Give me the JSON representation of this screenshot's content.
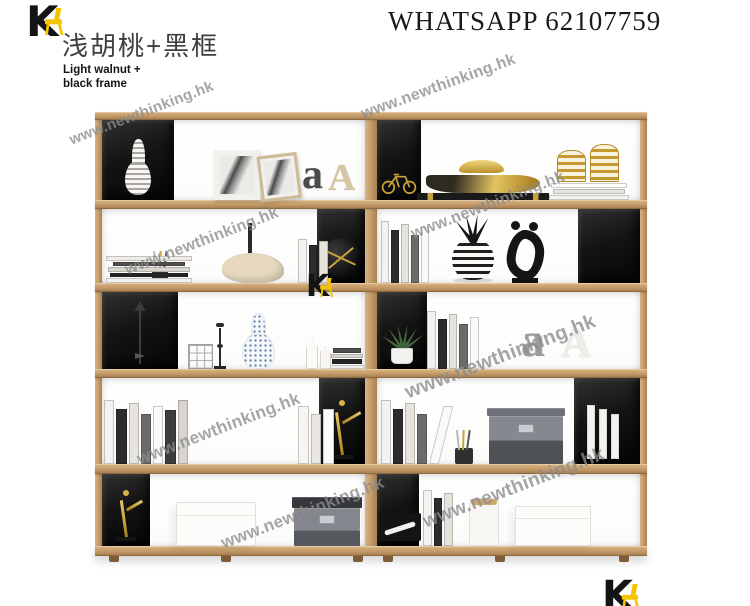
{
  "branding": {
    "logo_letter": "K",
    "logo_black": "#141414",
    "logo_yellow": "#f5c400",
    "title_cn": "浅胡桃+黑框",
    "title_en_line1": "Light walnut +",
    "title_en_line2": "black frame",
    "contact": "WHATSAPP 62107759"
  },
  "watermark": {
    "text": "www.newthinking.hk",
    "color": "#8c8c8c",
    "instances": [
      {
        "x": 70,
        "y": 132,
        "size": 15,
        "rot": -21
      },
      {
        "x": 362,
        "y": 106,
        "size": 16,
        "rot": -20
      },
      {
        "x": 126,
        "y": 262,
        "size": 16,
        "rot": -21
      },
      {
        "x": 412,
        "y": 226,
        "size": 16,
        "rot": -21
      },
      {
        "x": 138,
        "y": 450,
        "size": 17,
        "rot": -21
      },
      {
        "x": 406,
        "y": 382,
        "size": 20,
        "rot": -21
      },
      {
        "x": 424,
        "y": 512,
        "size": 19,
        "rot": -21
      },
      {
        "x": 222,
        "y": 534,
        "size": 17,
        "rot": -21
      }
    ]
  },
  "shelf": {
    "colors": {
      "wood_face": "#c79e6c",
      "wood_top": "#dcb988",
      "wood_edge": "#9a7243",
      "box": "#131313",
      "gold": "#c8a23c"
    },
    "units": [
      {
        "name": "left-unit",
        "rows": [
          {
            "box": "left",
            "box_item": {
              "kind": "vase",
              "name": "white-striped-vase",
              "w": 26,
              "h": 56
            },
            "items": [
              {
                "kind": "frame",
                "name": "white-picture-frame",
                "x": 112,
                "w": 46,
                "h": 50,
                "frame": "#f3f1ec"
              },
              {
                "kind": "frame",
                "name": "leaning-picture-frame",
                "x": 160,
                "w": 40,
                "h": 46,
                "frame": "#cdbb97",
                "lean": -7
              },
              {
                "kind": "letters",
                "name": "letter-a-ornament",
                "x": 200,
                "h": 42,
                "text": "a",
                "color": "#4c4c4c"
              },
              {
                "kind": "letters",
                "name": "letter-A-ornament",
                "x": 226,
                "h": 38,
                "text": "A",
                "color": "#d8c5a2"
              }
            ]
          },
          {
            "box": "right",
            "box_item": {
              "kind": "circle_fan",
              "name": "black-fan-clock",
              "w": 40,
              "h": 40
            },
            "items": [
              {
                "kind": "stick",
                "name": "spike-ornament",
                "x": 146,
                "w": 4,
                "h": 60,
                "color": "#2a2a2a"
              },
              {
                "kind": "pen_cup",
                "name": "pencil-cup",
                "x": 50,
                "w": 16,
                "h": 32
              },
              {
                "kind": "books_h",
                "name": "stacked-books",
                "x": 4,
                "w": 86,
                "h": 28,
                "n": 5
              },
              {
                "kind": "blob",
                "name": "rhino-sculpture",
                "x": 120,
                "w": 62,
                "h": 30,
                "color": "#e6d9bf"
              },
              {
                "kind": "books_v",
                "name": "leaning-books",
                "x": 196,
                "w": 32,
                "h": 44,
                "n": 3
              }
            ]
          },
          {
            "box": "left",
            "box_item": {
              "kind": "arrow",
              "name": "arrow-ornament",
              "w": 26,
              "h": 62
            },
            "items": [
              {
                "kind": "wire_cube",
                "name": "wire-cube-ornament",
                "x": 86,
                "w": 25,
                "h": 25
              },
              {
                "kind": "candlestick",
                "name": "black-candlestick",
                "x": 112,
                "w": 12,
                "h": 46
              },
              {
                "kind": "porcelain",
                "name": "blue-white-porcelain-vase",
                "x": 140,
                "w": 33,
                "h": 56
              },
              {
                "kind": "house",
                "name": "white-house-ornaments",
                "x": 204,
                "w": 26,
                "h": 32
              },
              {
                "kind": "books_h",
                "name": "book-stack",
                "x": 228,
                "w": 34,
                "h": 22,
                "n": 4
              }
            ]
          },
          {
            "box": "right",
            "box_item": {
              "kind": "figurine",
              "name": "gold-figurine",
              "w": 30,
              "h": 60
            },
            "items": [
              {
                "kind": "books_v",
                "name": "row-of-books",
                "x": 2,
                "w": 86,
                "h": 64,
                "n": 7
              },
              {
                "kind": "fan_leaves",
                "name": "round-black-ornament",
                "x": 114,
                "w": 72,
                "h": 58
              },
              {
                "kind": "books_v",
                "name": "white-books",
                "x": 196,
                "w": 38,
                "h": 58,
                "n": 3,
                "light": true
              }
            ]
          },
          {
            "box": "left",
            "box_item": {
              "kind": "figurine",
              "name": "gold-figurine-small",
              "w": 26,
              "h": 52
            },
            "items": [
              {
                "kind": "white_box",
                "name": "white-storage-box",
                "x": 74,
                "w": 80,
                "h": 44
              },
              {
                "kind": "box_stack",
                "name": "gray-storage-boxes",
                "x": 192,
                "w": 66,
                "h": 52,
                "layers": [
                  {
                    "h": 16,
                    "color": "#55595e"
                  },
                  {
                    "h": 22,
                    "color": "#83878d",
                    "label": true
                  },
                  {
                    "h": 11,
                    "color": "#35373b",
                    "lid": true
                  }
                ]
              }
            ]
          }
        ]
      },
      {
        "name": "right-unit",
        "rows": [
          {
            "box": "left",
            "box_item": {
              "kind": "bicycle",
              "name": "gold-bicycle-figurine",
              "w": 36,
              "h": 26
            },
            "items": [
              {
                "kind": "boat",
                "name": "gold-boat-sculpture",
                "x": 40,
                "w": 132,
                "h": 46
              },
              {
                "kind": "books_h",
                "name": "white-book-stack",
                "x": 172,
                "w": 80,
                "h": 18,
                "n": 3,
                "light": true
              },
              {
                "kind": "jars",
                "name": "gold-striped-jars",
                "x": 180,
                "w": 62,
                "h": 38,
                "b": 18
              }
            ]
          },
          {
            "box": "right",
            "items": [
              {
                "kind": "books_v",
                "name": "row-of-books",
                "x": 4,
                "w": 50,
                "h": 62,
                "n": 5
              },
              {
                "kind": "pineapple",
                "name": "pineapple-vase",
                "x": 72,
                "w": 48,
                "h": 70
              },
              {
                "kind": "ring",
                "name": "black-abstract-sculpture",
                "x": 126,
                "w": 44,
                "h": 62
              }
            ]
          },
          {
            "box": "left",
            "box_item": {
              "kind": "plant",
              "name": "potted-succulent",
              "w": 34,
              "h": 44
            },
            "items": [
              {
                "kind": "books_v",
                "name": "books",
                "x": 50,
                "w": 54,
                "h": 58,
                "n": 5
              },
              {
                "kind": "letters",
                "name": "letter-a-ornament",
                "x": 144,
                "h": 48,
                "text": "a",
                "color": "#9c9c9c"
              },
              {
                "kind": "letters",
                "name": "letter-A-ornament",
                "x": 184,
                "h": 42,
                "text": "A",
                "color": "#f0ede7"
              }
            ]
          },
          {
            "box": "right",
            "box_item": {
              "kind": "folders",
              "name": "white-folders",
              "w": 40,
              "h": 54
            },
            "items": [
              {
                "kind": "books_v",
                "name": "leaning-books",
                "x": 4,
                "w": 60,
                "h": 64,
                "n": 5,
                "lean": true
              },
              {
                "kind": "pen_cup",
                "name": "black-pen-cup",
                "x": 78,
                "w": 18,
                "h": 34
              },
              {
                "kind": "box_stack",
                "name": "gray-box-stack",
                "x": 112,
                "w": 74,
                "h": 56,
                "layers": [
                  {
                    "h": 24,
                    "color": "#4e5257"
                  },
                  {
                    "h": 24,
                    "color": "#84888f",
                    "label": true
                  },
                  {
                    "h": 8,
                    "color": "#6e7278",
                    "lid": true
                  }
                ]
              }
            ]
          },
          {
            "box": "left",
            "box_item": {
              "kind": "tissue",
              "name": "black-ornament-box",
              "w": 42,
              "h": 28
            },
            "items": [
              {
                "kind": "books_v",
                "name": "books",
                "x": 46,
                "w": 32,
                "h": 56,
                "n": 3
              },
              {
                "kind": "cylinder",
                "name": "white-canister",
                "x": 92,
                "w": 30,
                "h": 48
              },
              {
                "kind": "white_box",
                "name": "white-box",
                "x": 138,
                "w": 76,
                "h": 40
              }
            ]
          }
        ]
      }
    ]
  }
}
